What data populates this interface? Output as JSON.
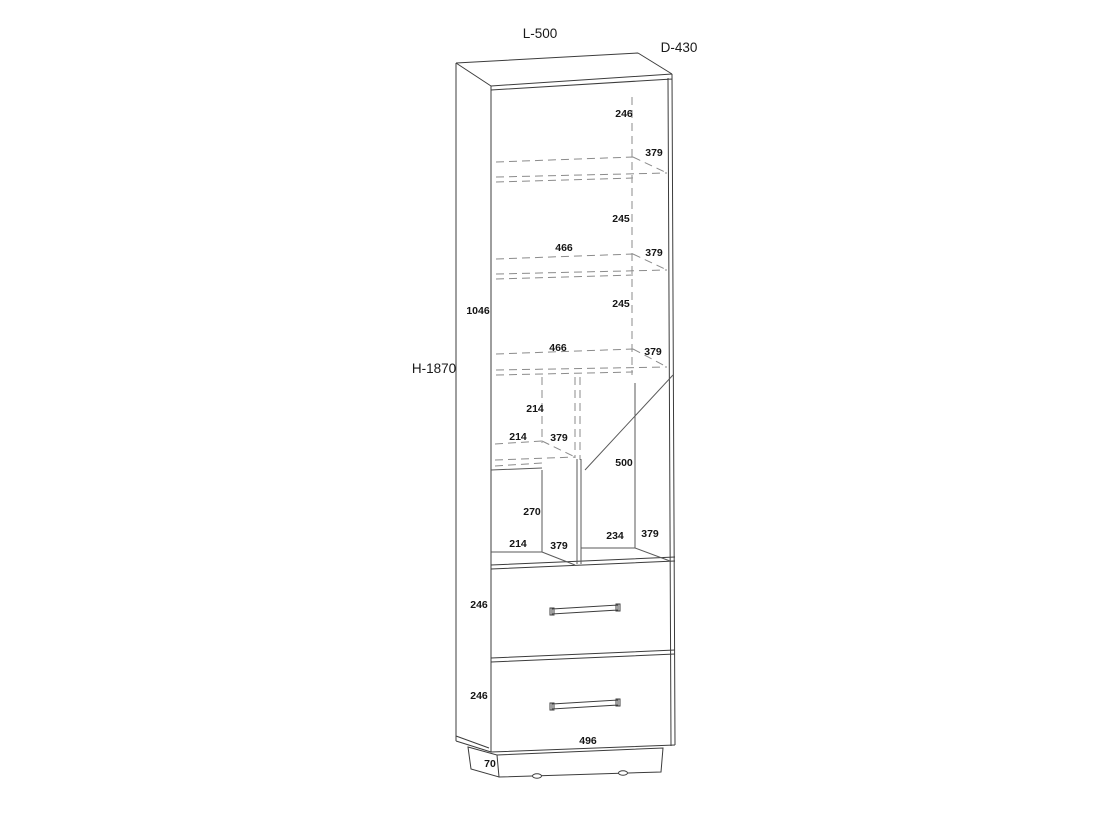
{
  "drawing": {
    "kind": "cabinet technical drawing",
    "dims": {
      "L": "L-500",
      "D": "D-430",
      "H": "H-1870",
      "upper_height": "1046",
      "top_gap": "246",
      "shelf1_depth": "379",
      "gap12": "245",
      "shelf2_width": "466",
      "shelf2_depth": "379",
      "gap23": "245",
      "shelf3_width": "466",
      "shelf3_depth": "379",
      "niche_height": "214",
      "niche_width": "214",
      "niche_depth": "379",
      "door_diag": "500",
      "cubby_height": "270",
      "cubby_width": "214",
      "cubby_depth": "379",
      "rniche_width": "234",
      "rniche_depth": "379",
      "drawer1_height": "246",
      "drawer2_height": "246",
      "drawer_width": "496",
      "plinth_height": "70"
    }
  }
}
